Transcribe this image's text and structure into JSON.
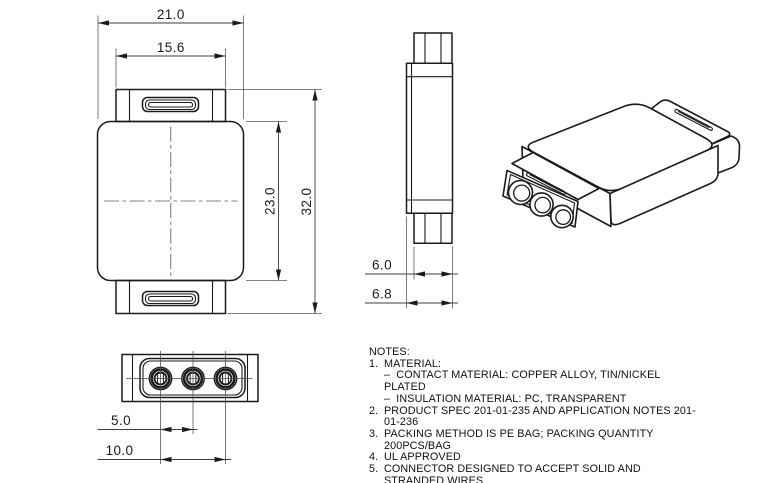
{
  "drawing": {
    "background": "#ffffff",
    "line_color": "#1b1b1b",
    "views": {
      "front": {
        "label": "front-view",
        "dims": {
          "overall_width": "21.0",
          "tab_width": "15.6",
          "body_height": "23.0",
          "overall_height": "32.0"
        }
      },
      "side": {
        "label": "side-view",
        "dims": {
          "tab_thickness": "6.0",
          "body_thickness": "6.8"
        }
      },
      "bottom": {
        "label": "bottom-view",
        "dims": {
          "hole_pitch": "5.0",
          "hole_span": "10.0"
        }
      },
      "isometric": {
        "label": "isometric-view"
      }
    },
    "notes": {
      "title": "NOTES:",
      "lines": [
        {
          "n": "1.",
          "t": "MATERIAL:"
        },
        {
          "n": "",
          "t": "–  CONTACT MATERIAL: COPPER ALLOY, TIN/NICKEL PLATED"
        },
        {
          "n": "",
          "t": "–  INSULATION MATERIAL: PC, TRANSPARENT"
        },
        {
          "n": "2.",
          "t": "PRODUCT SPEC 201-01-235 AND APPLICATION NOTES 201-01-236"
        },
        {
          "n": "3.",
          "t": "PACKING METHOD IS PE BAG; PACKING QUANTITY 200PCS/BAG"
        },
        {
          "n": "4.",
          "t": "UL APPROVED"
        },
        {
          "n": "5.",
          "t": "CONNECTOR DESIGNED TO ACCEPT SOLID AND STRANDED WIRES."
        }
      ]
    }
  }
}
